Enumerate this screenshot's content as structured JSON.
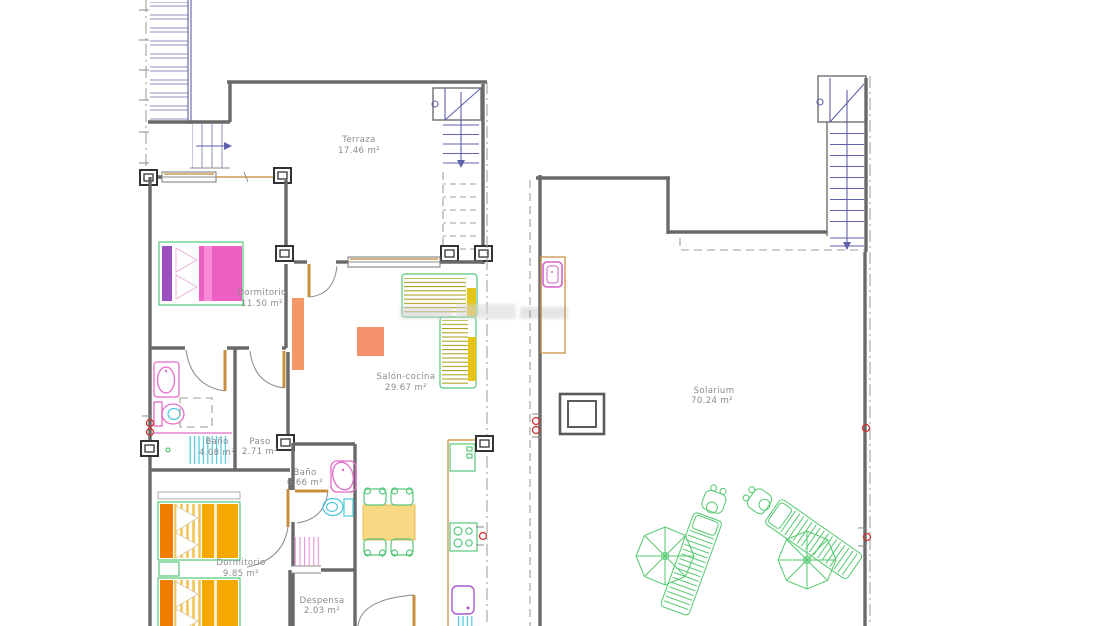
{
  "document": {
    "kind": "architectural floor plan drawing",
    "background": "#ffffff"
  },
  "lower_floor": {
    "rooms": {
      "terraza": {
        "label": "Terraza",
        "area": "17.46 m²"
      },
      "dormitorio1": {
        "label": "Dormitorio",
        "area": "11.50 m²"
      },
      "salon": {
        "label": "Salón-cocina",
        "area": "29.67 m²"
      },
      "bano1": {
        "label": "Baño",
        "area": "4.08 m²"
      },
      "paso": {
        "label": "Paso",
        "area": "2.71 m²"
      },
      "bano2": {
        "label": "Baño",
        "area": "6.66 m²"
      },
      "dormitorio2": {
        "label": "Dormitorio",
        "area": "9.85 m²"
      },
      "despensa": {
        "label": "Despensa",
        "area": "2.03 m²"
      }
    }
  },
  "roof_floor": {
    "rooms": {
      "solarium": {
        "label": "Solarium",
        "area": "70.24 m²"
      }
    }
  },
  "palette": {
    "wall_gray": "#696969",
    "stair_blue": "#5d61aa",
    "door_tan": "#cf9a52",
    "bed_pink": "#ee5fc4",
    "wardrobe_purple": "#9b4fc0",
    "bed_orange": "#f5a800",
    "bed_orange_dark": "#f07d00",
    "sofa_yellow": "#fbf7c0",
    "sofa_stripe_olive": "#a8a018",
    "sofa_arm_yellow": "#e4c419",
    "table_salmon": "#f4906a",
    "dining_table_yellow": "#f8d883",
    "fixture_pink": "#e36cc8",
    "fixture_cyan": "#4cc8dc",
    "kitchen_green": "#57c87c",
    "sink_purple": "#a958cc",
    "garden_green": "#53c96f",
    "marker_red": "#cc3333",
    "label_gray": "#8c8c8c"
  }
}
